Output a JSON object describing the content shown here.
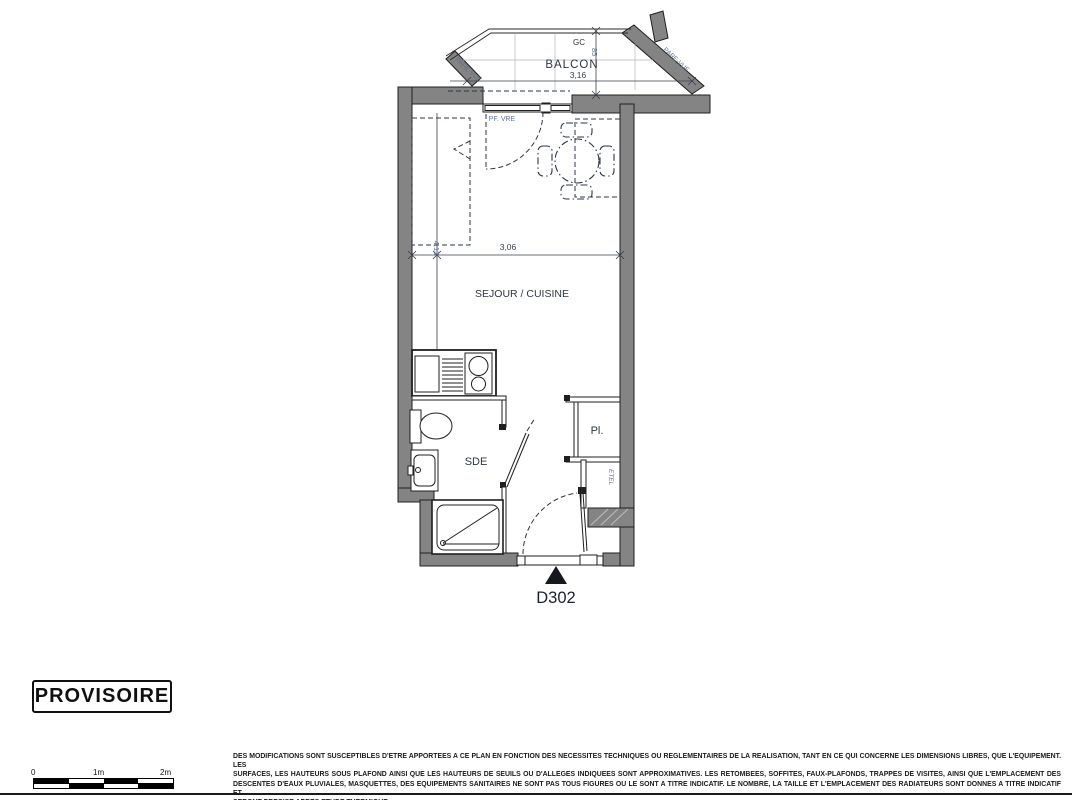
{
  "plan": {
    "unit": "D302",
    "rooms": {
      "balcony": "BALCON",
      "living": "SEJOUR / CUISINE",
      "shower_room": "SDE",
      "closet": "Pl."
    },
    "labels": {
      "gc": "GC",
      "window": "PF. VRE",
      "pare_vue_left": "PARE-VUE",
      "pare_vue_right": "PARE-VUE",
      "shelf": "ETEL"
    },
    "dimensions": {
      "balcony_width": "3,16",
      "balcony_depth": "85",
      "living_width": "3,06",
      "living_depth": "4,13"
    }
  },
  "stamp": {
    "label": "PROVISOIRE"
  },
  "scale_bar": {
    "tick_0": "0",
    "tick_1": "1m",
    "tick_2": "2m"
  },
  "disclaimer": {
    "lines": [
      "DES MODIFICATIONS SONT SUSCEPTIBLES D'ETRE APPORTEES A CE PLAN EN FONCTION DES NECESSITES TECHNIQUES OU REGLEMENTAIRES DE LA REALISATION, TANT EN CE QUI CONCERNE LES DIMENSIONS LIBRES, QUE L'EQUIPEMENT. LES",
      "SURFACES, LES HAUTEURS SOUS PLAFOND AINSI QUE LES HAUTEURS DE SEUILS OU D'ALLEGES INDIQUEES SONT APPROXIMATIVES. LES RETOMBEES, SOFFITES, FAUX-PLAFONDS, TRAPPES DE VISITES, AINSI QUE L'EMPLACEMENT DES",
      "DESCENTES D'EAUX PLUVIALES, MASQUETTES, DES EQUIPEMENTS SANITAIRES NE SONT PAS TOUS FIGURES OU LE SONT A TITRE INDICATIF. LE NOMBRE, LA TAILLE ET L'EMPLACEMENT DES RADIATEURS SONT DONNES A TITRE INDICATIF ET",
      "SERONT PRECISE APRES ETUDE THERMIQUE."
    ]
  },
  "colors": {
    "wall": "#848484",
    "line": "#1f1f1f",
    "label_blue": "#5f7091",
    "label_dark": "#2e3644",
    "marker": "#15181d"
  }
}
